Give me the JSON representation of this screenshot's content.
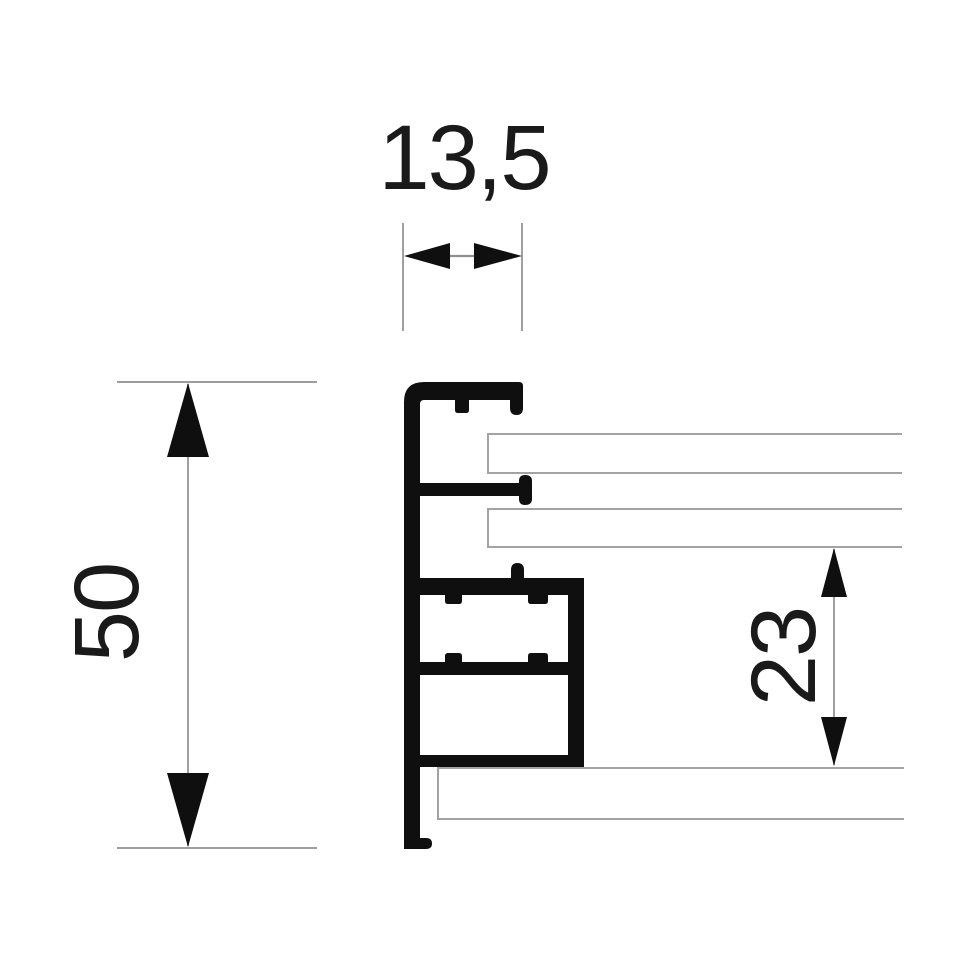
{
  "dimensions": {
    "width_top": {
      "label": "13,5",
      "value": 13.5
    },
    "height_left": {
      "label": "50",
      "value": 50
    },
    "offset_right": {
      "label": "23",
      "value": 23
    }
  },
  "colors": {
    "ink": "#0f0f0f",
    "text": "#1a1a1a",
    "dim_line": "#8f8f8f",
    "panel_line": "#a3a3a3",
    "background": "#ffffff"
  }
}
